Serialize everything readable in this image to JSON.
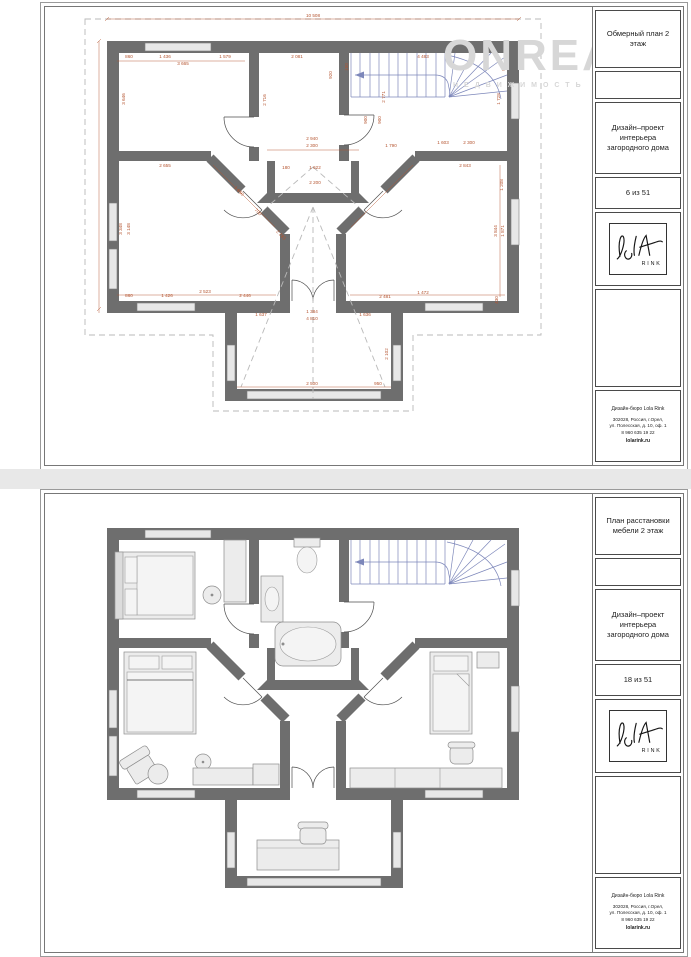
{
  "colors": {
    "wall": "#6e6e6e",
    "window": "#e7e7e7",
    "dimension": "#b4532e",
    "stairs": "#7d87ba",
    "dashed": "#b9b9b9",
    "watermark": "#d7d7d7"
  },
  "watermark": {
    "text": "ONREALT",
    "sub": "НЕДВИЖИМОСТЬ"
  },
  "shared": {
    "project": "Дизайн–проект интерьера загородного дома",
    "logo_caption": "RINK",
    "bureau": {
      "name": "Дизайн-бюро Lola Rink",
      "address1": "302028, Россия, г.Орел,",
      "address2": "ул. Полесская, д. 10, оф. 1",
      "phone": "8 960 635 19 22",
      "site": "lolarink.ru"
    }
  },
  "sheet1": {
    "title": "Обмерный план 2 этаж",
    "page": "6 из 51",
    "dim_labels": [
      {
        "t": "10 508",
        "x": 268,
        "y": 10
      },
      {
        "t": "860",
        "x": 84,
        "y": 51
      },
      {
        "t": "1 436",
        "x": 120,
        "y": 51
      },
      {
        "t": "1 579",
        "x": 180,
        "y": 51
      },
      {
        "t": "3 665",
        "x": 138,
        "y": 58
      },
      {
        "t": "2 081",
        "x": 252,
        "y": 51
      },
      {
        "t": "920",
        "x": 287,
        "y": 68,
        "r": -90
      },
      {
        "t": "4 483",
        "x": 378,
        "y": 51
      },
      {
        "t": "900",
        "x": 460,
        "y": 60,
        "r": -90
      },
      {
        "t": "3 646",
        "x": 80,
        "y": 92,
        "r": -90
      },
      {
        "t": "2 716",
        "x": 221,
        "y": 93,
        "r": -90
      },
      {
        "t": "150",
        "x": 303,
        "y": 60,
        "r": -90
      },
      {
        "t": "2 771",
        "x": 340,
        "y": 90,
        "r": -90
      },
      {
        "t": "900",
        "x": 322,
        "y": 113,
        "r": -90
      },
      {
        "t": "900",
        "x": 336,
        "y": 113,
        "r": -90
      },
      {
        "t": "1 603",
        "x": 398,
        "y": 137
      },
      {
        "t": "2 300",
        "x": 424,
        "y": 137
      },
      {
        "t": "1 728",
        "x": 455,
        "y": 92,
        "r": -90
      },
      {
        "t": "2 940",
        "x": 267,
        "y": 133
      },
      {
        "t": "2 300",
        "x": 267,
        "y": 140
      },
      {
        "t": "180",
        "x": 241,
        "y": 162
      },
      {
        "t": "1 622",
        "x": 270,
        "y": 162
      },
      {
        "t": "2 200",
        "x": 270,
        "y": 177
      },
      {
        "t": "1 790",
        "x": 346,
        "y": 140
      },
      {
        "t": "2 655",
        "x": 120,
        "y": 160
      },
      {
        "t": "3 348",
        "x": 77,
        "y": 222,
        "r": -90
      },
      {
        "t": "3 148",
        "x": 85,
        "y": 222,
        "r": -90
      },
      {
        "t": "1 650",
        "x": 193,
        "y": 185,
        "r": 45
      },
      {
        "t": "700",
        "x": 212,
        "y": 206,
        "r": 45
      },
      {
        "t": "2 283",
        "x": 235,
        "y": 229,
        "r": 45
      },
      {
        "t": "860",
        "x": 84,
        "y": 290
      },
      {
        "t": "1 426",
        "x": 122,
        "y": 290
      },
      {
        "t": "2 523",
        "x": 160,
        "y": 286
      },
      {
        "t": "2 446",
        "x": 200,
        "y": 290
      },
      {
        "t": "2 843",
        "x": 420,
        "y": 160
      },
      {
        "t": "1 208",
        "x": 458,
        "y": 178,
        "r": -90
      },
      {
        "t": "3 844",
        "x": 452,
        "y": 224,
        "r": -90
      },
      {
        "t": "1 871",
        "x": 459,
        "y": 224,
        "r": -90
      },
      {
        "t": "430",
        "x": 453,
        "y": 293,
        "r": -90
      },
      {
        "t": "1 472",
        "x": 378,
        "y": 287
      },
      {
        "t": "2 481",
        "x": 340,
        "y": 291
      },
      {
        "t": "1 637",
        "x": 216,
        "y": 309
      },
      {
        "t": "1 384",
        "x": 267,
        "y": 306
      },
      {
        "t": "1 636",
        "x": 320,
        "y": 309
      },
      {
        "t": "4 810",
        "x": 267,
        "y": 313
      },
      {
        "t": "2 102",
        "x": 343,
        "y": 347,
        "r": -90
      },
      {
        "t": "2 500",
        "x": 267,
        "y": 378
      },
      {
        "t": "950",
        "x": 333,
        "y": 378
      }
    ]
  },
  "sheet2": {
    "title": "План расстановки мебели 2 этаж",
    "page": "18 из 51"
  }
}
